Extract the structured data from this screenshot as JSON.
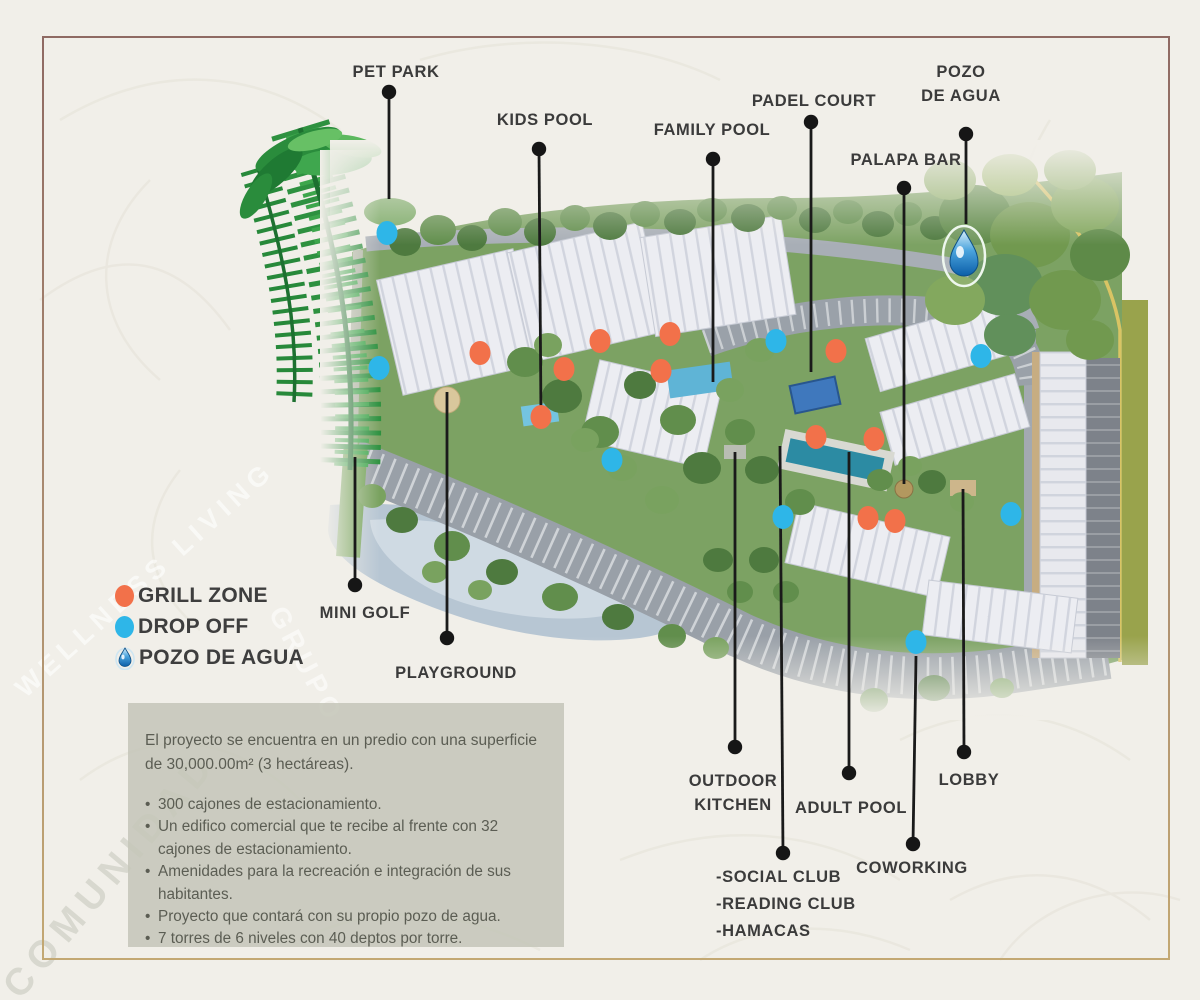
{
  "canvas": {
    "width": 1200,
    "height": 1000,
    "background": "#f1efe9",
    "border_top_color": "#8f6a63",
    "border_bottom_color": "#c3a873"
  },
  "legend": {
    "items": [
      {
        "id": "grill-zone",
        "label": "GRILL ZONE",
        "swatch": "circle",
        "color": "#f2714a"
      },
      {
        "id": "drop-off",
        "label": "DROP OFF",
        "swatch": "circle",
        "color": "#2eb6e8"
      },
      {
        "id": "pozo-de-agua",
        "label": "POZO DE AGUA",
        "swatch": "droplet",
        "color": "#2f86c8"
      }
    ]
  },
  "map": {
    "labels": [
      {
        "id": "pet-park",
        "text_lines": [
          "PET PARK"
        ],
        "x": 396,
        "y": 60,
        "align": "center",
        "dot": [
          389,
          92
        ],
        "leader": [
          389,
          92,
          389,
          199
        ]
      },
      {
        "id": "kids-pool",
        "text_lines": [
          "KIDS POOL"
        ],
        "x": 545,
        "y": 108,
        "align": "center",
        "dot": [
          539,
          149
        ],
        "leader": [
          539,
          149,
          541,
          418
        ]
      },
      {
        "id": "family-pool",
        "text_lines": [
          "FAMILY POOL"
        ],
        "x": 712,
        "y": 118,
        "align": "center",
        "dot": [
          713,
          159
        ],
        "leader": [
          713,
          159,
          713,
          382
        ]
      },
      {
        "id": "padel-court",
        "text_lines": [
          "PADEL COURT"
        ],
        "x": 814,
        "y": 89,
        "align": "center",
        "dot": [
          811,
          122
        ],
        "leader": [
          811,
          122,
          811,
          372
        ]
      },
      {
        "id": "pozo-de-agua",
        "text_lines": [
          "POZO",
          "DE AGUA"
        ],
        "x": 961,
        "y": 60,
        "align": "center",
        "dot": [
          966,
          134
        ],
        "leader": [
          966,
          134,
          966,
          224
        ]
      },
      {
        "id": "palapa-bar",
        "text_lines": [
          "PALAPA BAR"
        ],
        "x": 906,
        "y": 148,
        "align": "center",
        "dot": [
          904,
          188
        ],
        "leader": [
          904,
          188,
          904,
          484
        ]
      },
      {
        "id": "mini-golf",
        "text_lines": [
          "MINI GOLF"
        ],
        "x": 365,
        "y": 601,
        "align": "center",
        "dot": [
          355,
          585
        ],
        "leader": [
          355,
          457,
          355,
          585
        ]
      },
      {
        "id": "playground",
        "text_lines": [
          "PLAYGROUND"
        ],
        "x": 456,
        "y": 661,
        "align": "center",
        "dot": [
          447,
          638
        ],
        "leader": [
          447,
          392,
          447,
          638
        ]
      },
      {
        "id": "outdoor-kitchen",
        "text_lines": [
          "OUTDOOR",
          "KITCHEN"
        ],
        "x": 733,
        "y": 769,
        "align": "center",
        "dot": [
          735,
          747
        ],
        "leader": [
          735,
          452,
          735,
          747
        ]
      },
      {
        "id": "adult-pool",
        "text_lines": [
          "ADULT POOL"
        ],
        "x": 851,
        "y": 796,
        "align": "center",
        "dot": [
          849,
          773
        ],
        "leader": [
          849,
          452,
          849,
          773
        ]
      },
      {
        "id": "lobby",
        "text_lines": [
          "LOBBY"
        ],
        "x": 969,
        "y": 768,
        "align": "center",
        "dot": [
          964,
          752
        ],
        "leader": [
          963,
          489,
          964,
          752
        ]
      },
      {
        "id": "coworking",
        "text_lines": [
          "COWORKING"
        ],
        "x": 912,
        "y": 856,
        "align": "center",
        "dot": [
          913,
          844
        ],
        "leader": [
          916,
          656,
          913,
          844
        ]
      },
      {
        "id": "club-group",
        "text_lines": [
          "-SOCIAL CLUB",
          "-READING CLUB",
          "-HAMACAS"
        ],
        "x": 716,
        "y": 864,
        "align": "left",
        "line_height": 27,
        "dot": [
          783,
          853
        ],
        "leader": [
          780,
          446,
          783,
          853
        ]
      }
    ],
    "markers": {
      "grill_zone": {
        "color": "#f2714a",
        "points": [
          [
            480,
            353
          ],
          [
            564,
            369
          ],
          [
            600,
            341
          ],
          [
            670,
            334
          ],
          [
            661,
            371
          ],
          [
            541,
            417
          ],
          [
            836,
            351
          ],
          [
            816,
            437
          ],
          [
            874,
            439
          ],
          [
            868,
            518
          ],
          [
            895,
            521
          ]
        ]
      },
      "drop_off": {
        "color": "#2eb6e8",
        "points": [
          [
            387,
            233
          ],
          [
            379,
            368
          ],
          [
            612,
            460
          ],
          [
            776,
            341
          ],
          [
            981,
            356
          ],
          [
            783,
            517
          ],
          [
            1011,
            514
          ],
          [
            916,
            642
          ]
        ]
      },
      "water_well": {
        "x": 964,
        "y": 256
      }
    }
  },
  "infobox": {
    "intro": "El proyecto se encuentra en un predio con una superficie de 30,000.00m² (3 hectáreas).",
    "bullets": [
      "300 cajones de estacionamiento.",
      "Un edifico comercial que te recibe al frente con 32 cajones de estacionamiento.",
      "Amenidades para la recreación e integración de sus habitantes.",
      "Proyecto que contará con su propio pozo de agua.",
      "7 torres de 6 niveles con 40 deptos por torre."
    ]
  },
  "watermarks": [
    {
      "text": "WELLNESS LIVING",
      "x": 30,
      "y": 700,
      "rotate": -42,
      "size": 27,
      "letter_spacing": 6,
      "color": "rgba(255,255,255,0.6)"
    },
    {
      "text": "GRUPO",
      "x": 262,
      "y": 612,
      "rotate": 62,
      "size": 28,
      "letter_spacing": 5,
      "color": "rgba(255,255,255,0.55)"
    },
    {
      "text": "COMUNIDAD",
      "x": 28,
      "y": 1002,
      "rotate": -50,
      "size": 38,
      "letter_spacing": 8,
      "color": "rgba(164,168,152,0.32)"
    }
  ]
}
